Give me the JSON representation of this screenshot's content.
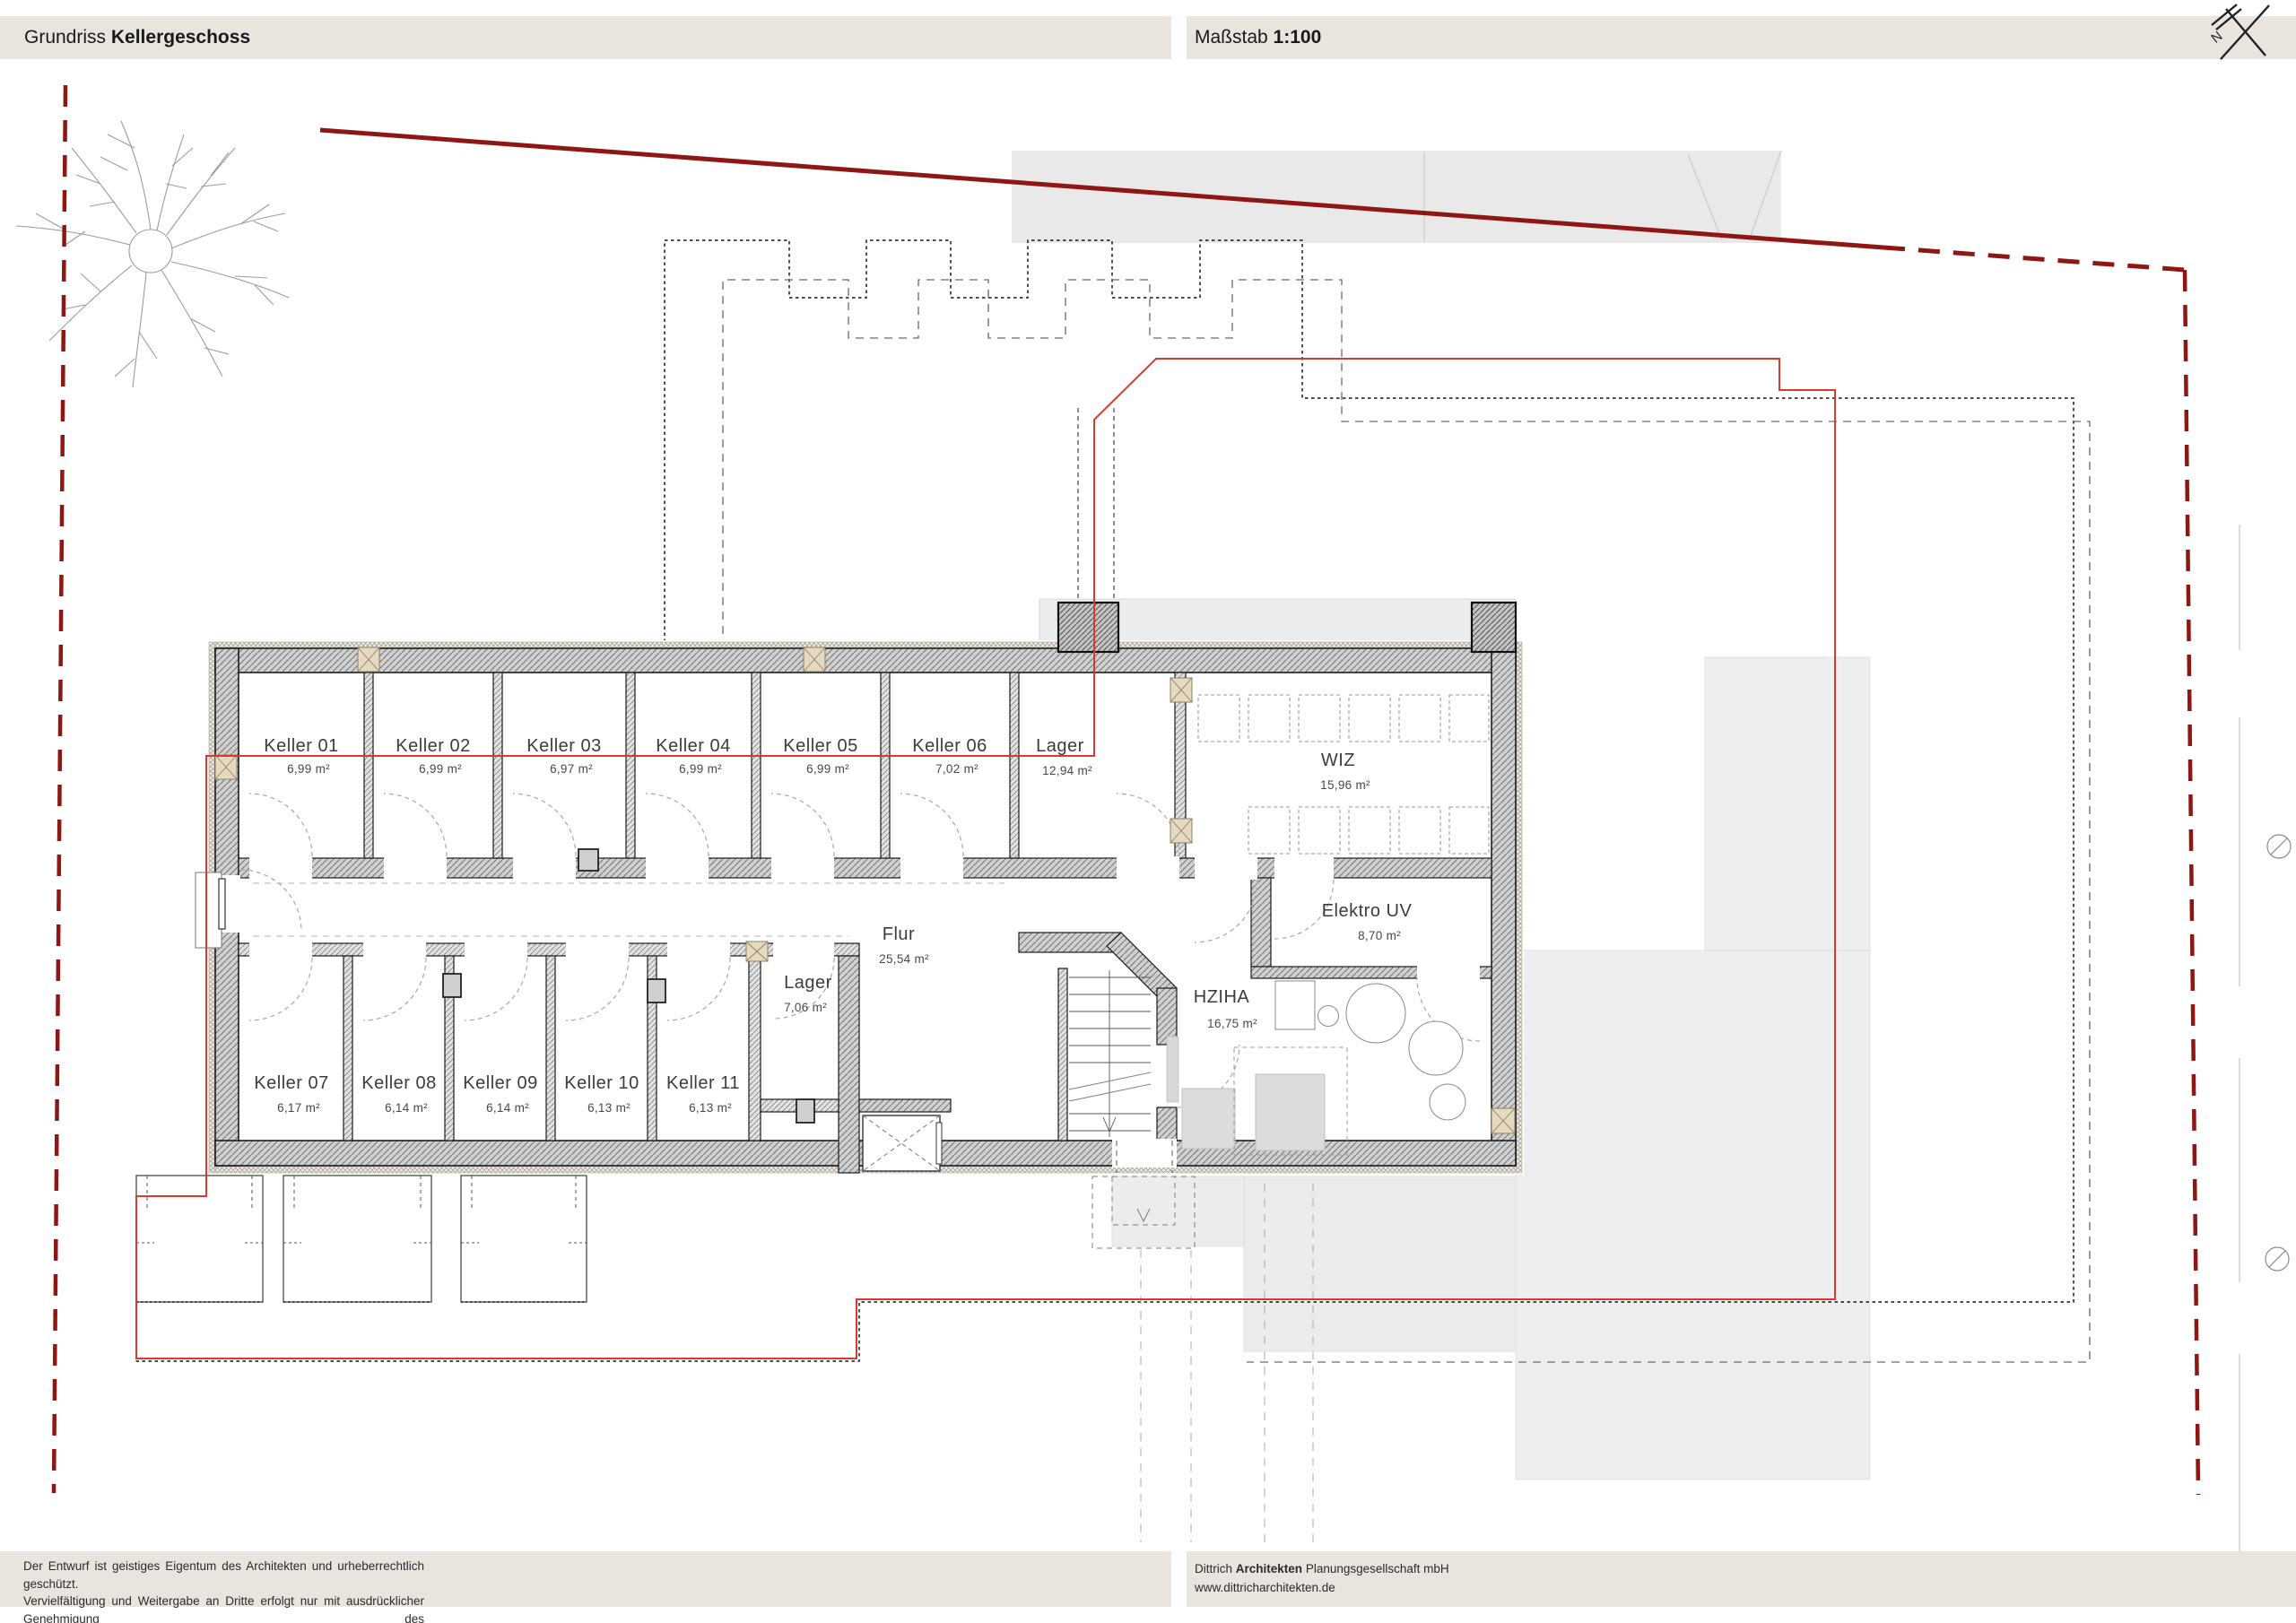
{
  "header": {
    "title_prefix": "Grundriss",
    "title_bold": "Kellergeschoss"
  },
  "scale_box": {
    "label": "Maßstab",
    "value": "1:100"
  },
  "icons": {
    "north": "north-arrow-icon",
    "boundary_marker": "circle-slash-icon",
    "tree": "site-tree-icon"
  },
  "rooms": {
    "k01": {
      "name": "Keller 01",
      "area": "6,99 m²"
    },
    "k02": {
      "name": "Keller 02",
      "area": "6,99 m²"
    },
    "k03": {
      "name": "Keller 03",
      "area": "6,97 m²"
    },
    "k04": {
      "name": "Keller 04",
      "area": "6,99 m²"
    },
    "k05": {
      "name": "Keller 05",
      "area": "6,99 m²"
    },
    "k06": {
      "name": "Keller 06",
      "area": "7,02 m²"
    },
    "lager_main": {
      "name": "Lager",
      "area": "12,94 m²"
    },
    "wiz": {
      "name": "WIZ",
      "area": "15,96 m²"
    },
    "elektro": {
      "name": "Elektro UV",
      "area": "8,70 m²"
    },
    "flur": {
      "name": "Flur",
      "area": "25,54 m²"
    },
    "lager_small": {
      "name": "Lager",
      "area": "7,06 m²"
    },
    "hziha": {
      "name": "HZIHA",
      "area": "16,75 m²"
    },
    "k07": {
      "name": "Keller 07",
      "area": "6,17 m²"
    },
    "k08": {
      "name": "Keller 08",
      "area": "6,14 m²"
    },
    "k09": {
      "name": "Keller 09",
      "area": "6,14 m²"
    },
    "k10": {
      "name": "Keller 10",
      "area": "6,13 m²"
    },
    "k11": {
      "name": "Keller 11",
      "area": "6,13 m²"
    }
  },
  "footer_left": {
    "lines": [
      "Der Entwurf ist geistiges Eigentum des Architekten und urheberrechtlich geschützt.",
      "Vervielfältigung und Weitergabe an Dritte erfolgt nur mit ausdrücklicher Genehmigung des",
      "Planverfassers. Bei Missbrauch bleiben rechtliche Schritte vorbehalten."
    ]
  },
  "footer_right": {
    "firm_prefix": "Dittrich",
    "firm_bold": "Architekten",
    "firm_suffix": "Planungsgesellschaft mbH",
    "website": "www.dittricharchitekten.de"
  },
  "colors": {
    "bar_bg": "#e9e5de",
    "boundary_red": "#8e1713",
    "overlay_red": "#d93a30",
    "wall_fill": "#d0d0d0",
    "shade_grey": "#efeeee"
  }
}
